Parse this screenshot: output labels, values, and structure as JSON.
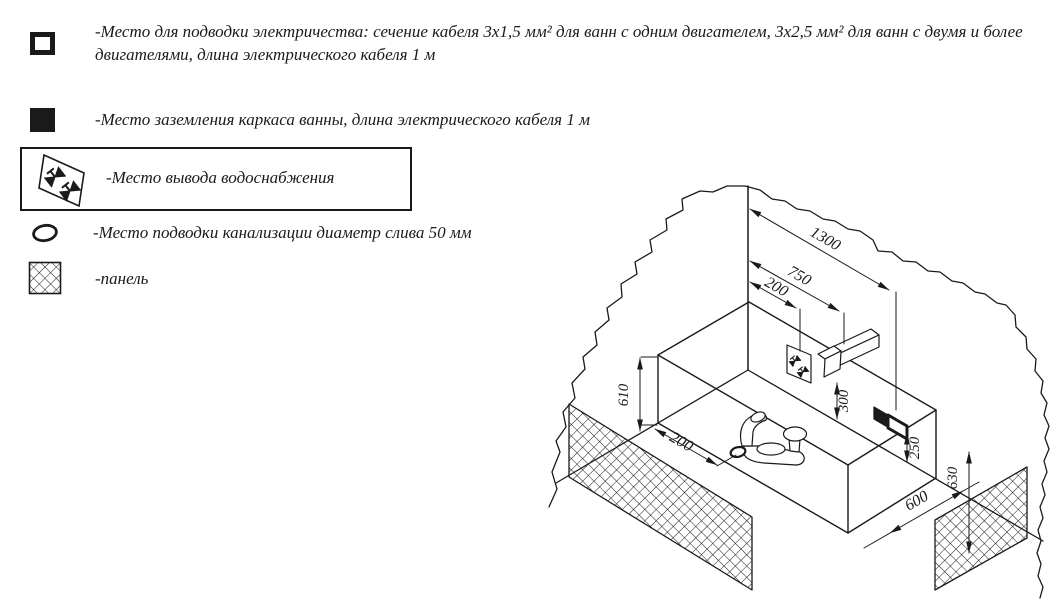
{
  "legend": {
    "items": [
      {
        "symbol": "electric-supply-square",
        "text": "-Место для подводки электричества: сечение кабеля 3х1,5 мм² для ванн с одним двигателем, 3х2,5 мм² для ванн с двумя и более двигателями, длина электрического кабеля 1 м"
      },
      {
        "symbol": "grounding-square",
        "text": "-Место заземления каркаса ванны, длина электрического кабеля 1 м"
      },
      {
        "symbol": "water-supply-valves",
        "text": "-Место вывода водоснабжения"
      },
      {
        "symbol": "drain-oval",
        "text": "-Место подводки канализации диаметр слива 50 мм"
      },
      {
        "symbol": "hatched-panel",
        "text": "-панель"
      }
    ]
  },
  "diagram": {
    "dims": {
      "wall_1300": "1300",
      "wall_750": "750",
      "wall_200": "200",
      "height_610": "610",
      "bottom_200": "200",
      "spout_300": "300",
      "outlet_250": "250",
      "panel_630": "630",
      "width_600": "600"
    }
  },
  "colors": {
    "line": "#1a1a1a",
    "background": "#ffffff"
  }
}
